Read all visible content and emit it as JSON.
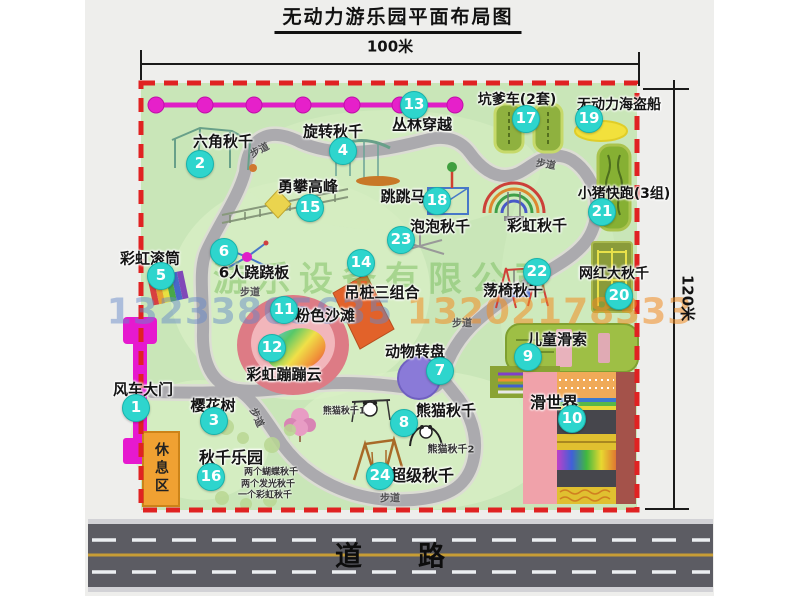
{
  "title": "无动力游乐园平面布局图",
  "dimensions": {
    "width_label": "100米",
    "height_label": "120米"
  },
  "road": {
    "label": "道路"
  },
  "rest_area": {
    "label": "休息区"
  },
  "path_label": "步道",
  "watermark": {
    "company": "游乐设备有限公司",
    "phone1": "13233805635",
    "phone2": "13202178333"
  },
  "colors": {
    "map_green": "#c9e6b8",
    "border_red": "#e02222",
    "badge": "#2ed5cd",
    "zipline_magenta": "#e61fc9",
    "road_gray": "#5c5c63",
    "rest_orange": "#f0a132"
  },
  "attractions": [
    {
      "num": 1,
      "name": "风车大门",
      "label": [
        143,
        389
      ],
      "badge": [
        136,
        408
      ],
      "size": 15
    },
    {
      "num": 2,
      "name": "六角秋千",
      "label": [
        223,
        141
      ],
      "badge": [
        200,
        164
      ],
      "size": 15
    },
    {
      "num": 3,
      "name": "樱花树",
      "label": [
        213,
        405
      ],
      "badge": [
        214,
        421
      ],
      "size": 15
    },
    {
      "num": 4,
      "name": "旋转秋千",
      "label": [
        333,
        131
      ],
      "badge": [
        343,
        151
      ],
      "size": 15
    },
    {
      "num": 5,
      "name": "彩虹滚筒",
      "label": [
        150,
        258
      ],
      "badge": [
        161,
        276
      ],
      "size": 15
    },
    {
      "num": 6,
      "name": "6人跷跷板",
      "label": [
        254,
        272
      ],
      "badge": [
        224,
        252
      ],
      "size": 15
    },
    {
      "num": 7,
      "name": "动物转盘",
      "label": [
        415,
        351
      ],
      "badge": [
        440,
        371
      ],
      "size": 15
    },
    {
      "num": 8,
      "name": "熊猫秋千",
      "label": [
        446,
        410
      ],
      "badge": [
        404,
        423
      ],
      "size": 15
    },
    {
      "num": 9,
      "name": "儿童滑索",
      "label": [
        557,
        339
      ],
      "badge": [
        528,
        357
      ],
      "size": 15
    },
    {
      "num": 10,
      "name": "滑世界",
      "label": [
        554,
        401
      ],
      "badge": [
        572,
        419
      ],
      "size": 16
    },
    {
      "num": 11,
      "name": "粉色沙滩",
      "label": [
        325,
        315
      ],
      "badge": [
        284,
        310
      ],
      "size": 15
    },
    {
      "num": 12,
      "name": "彩虹蹦蹦云",
      "label": [
        284,
        374
      ],
      "badge": [
        272,
        348
      ],
      "size": 15
    },
    {
      "num": 13,
      "name": "丛林穿越",
      "label": [
        422,
        124
      ],
      "badge": [
        414,
        105
      ],
      "size": 15
    },
    {
      "num": 14,
      "name": "吊桩三组合",
      "label": [
        382,
        292
      ],
      "badge": [
        361,
        263
      ],
      "size": 15
    },
    {
      "num": 15,
      "name": "勇攀高峰",
      "label": [
        308,
        186
      ],
      "badge": [
        310,
        208
      ],
      "size": 15
    },
    {
      "num": 16,
      "name": "秋千乐园",
      "label": [
        231,
        456
      ],
      "badge": [
        211,
        477
      ],
      "size": 16
    },
    {
      "num": 17,
      "name": "坑爹车(2套)",
      "label": [
        517,
        99
      ],
      "badge": [
        526,
        119
      ],
      "size": 14
    },
    {
      "num": 18,
      "name": "跳跳马",
      "label": [
        403,
        196
      ],
      "badge": [
        437,
        201
      ],
      "size": 15
    },
    {
      "num": 19,
      "name": "无动力海盗船",
      "label": [
        619,
        104
      ],
      "badge": [
        589,
        119
      ],
      "size": 14
    },
    {
      "num": 20,
      "name": "网红大秋千",
      "label": [
        614,
        273
      ],
      "badge": [
        619,
        296
      ],
      "size": 14
    },
    {
      "num": 21,
      "name": "小猪快跑(3组)",
      "label": [
        624,
        193
      ],
      "badge": [
        602,
        212
      ],
      "size": 14
    },
    {
      "num": 22,
      "name": "荡椅秋千",
      "label": [
        513,
        290
      ],
      "badge": [
        537,
        272
      ],
      "size": 15
    },
    {
      "num": 23,
      "name": "泡泡秋千",
      "label": [
        440,
        226
      ],
      "badge": [
        401,
        240
      ],
      "size": 15
    },
    {
      "num": 24,
      "name": "超级秋千",
      "label": [
        422,
        474
      ],
      "badge": [
        380,
        476
      ],
      "size": 16
    },
    {
      "num": null,
      "name": "彩虹秋千",
      "label": [
        537,
        225
      ],
      "badge": null,
      "size": 15
    }
  ],
  "sub_labels": [
    {
      "text": "熊猫秋千1",
      "x": 344,
      "y": 410,
      "size": 9
    },
    {
      "text": "熊猫秋千2",
      "x": 451,
      "y": 448,
      "size": 10
    },
    {
      "text": "两个蝴蝶秋千",
      "x": 271,
      "y": 471,
      "size": 9
    },
    {
      "text": "两个发光秋千",
      "x": 268,
      "y": 483,
      "size": 9
    },
    {
      "text": "一个彩虹秋千",
      "x": 265,
      "y": 494,
      "size": 9
    }
  ],
  "path_labels": [
    {
      "x": 259,
      "y": 149,
      "r": -28
    },
    {
      "x": 546,
      "y": 163,
      "r": 10
    },
    {
      "x": 250,
      "y": 291,
      "r": 0
    },
    {
      "x": 462,
      "y": 322,
      "r": 0
    },
    {
      "x": 258,
      "y": 417,
      "r": 65
    },
    {
      "x": 390,
      "y": 497,
      "r": 0
    }
  ]
}
